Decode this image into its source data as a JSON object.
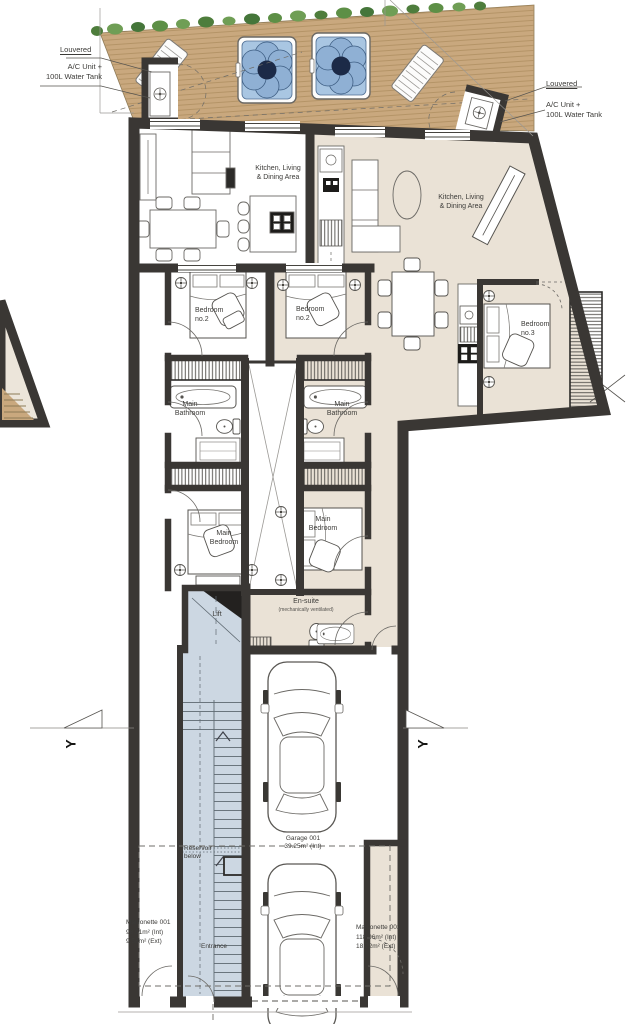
{
  "document": {
    "type": "architectural floor plan"
  },
  "colors": {
    "wall": "#3a3734",
    "unit2_floor": "#eae2d6",
    "deck_wood": "#c9a87e",
    "lift_stair_floor": "#ccd7e2",
    "hot_tub_water": "#a9c6e2",
    "greenery": "#5d8f46"
  },
  "units": [
    {
      "name": "Maisonette 001",
      "area_internal": "98.91m² (Int)",
      "area_external": "9.58m² (Ext)",
      "rooms": [
        "Kitchen, Living & Dining Area",
        "Bedroom no.2",
        "Main Bathroom",
        "Main Bedroom",
        "Lift",
        "Entrance"
      ]
    },
    {
      "name": "Maisonette 002",
      "area_internal": "118.96m² (Int)",
      "area_external": "18.72m² (Ext)",
      "rooms": [
        "Kitchen, Living & Dining Area",
        "Bedroom no.2",
        "Bedroom no.3",
        "Main Bathroom",
        "Main Bedroom",
        "En-suite (mechanically ventilated)"
      ]
    }
  ],
  "garage": {
    "name": "Garage 001",
    "area": "39.25m² (Int)"
  },
  "labels": {
    "louvered": "Louvered",
    "ac_unit_line1": "A/C Unit +",
    "ac_unit_line2": "100L Water Tank",
    "kitchen_line1": "Kitchen, Living",
    "kitchen_line2": "& Dining Area",
    "bedroom": "Bedroom",
    "bedroom_no2": "no.2",
    "bedroom_no3": "no.3",
    "main": "Main",
    "bathroom": "Bathroom",
    "lift": "Lift",
    "ensuite": "En-suite",
    "ensuite_note": "(mechanically ventilated)",
    "reservoir_line1": "Reservoir",
    "reservoir_line2": "below",
    "entrance": "Entrance",
    "section_y": "Y"
  }
}
